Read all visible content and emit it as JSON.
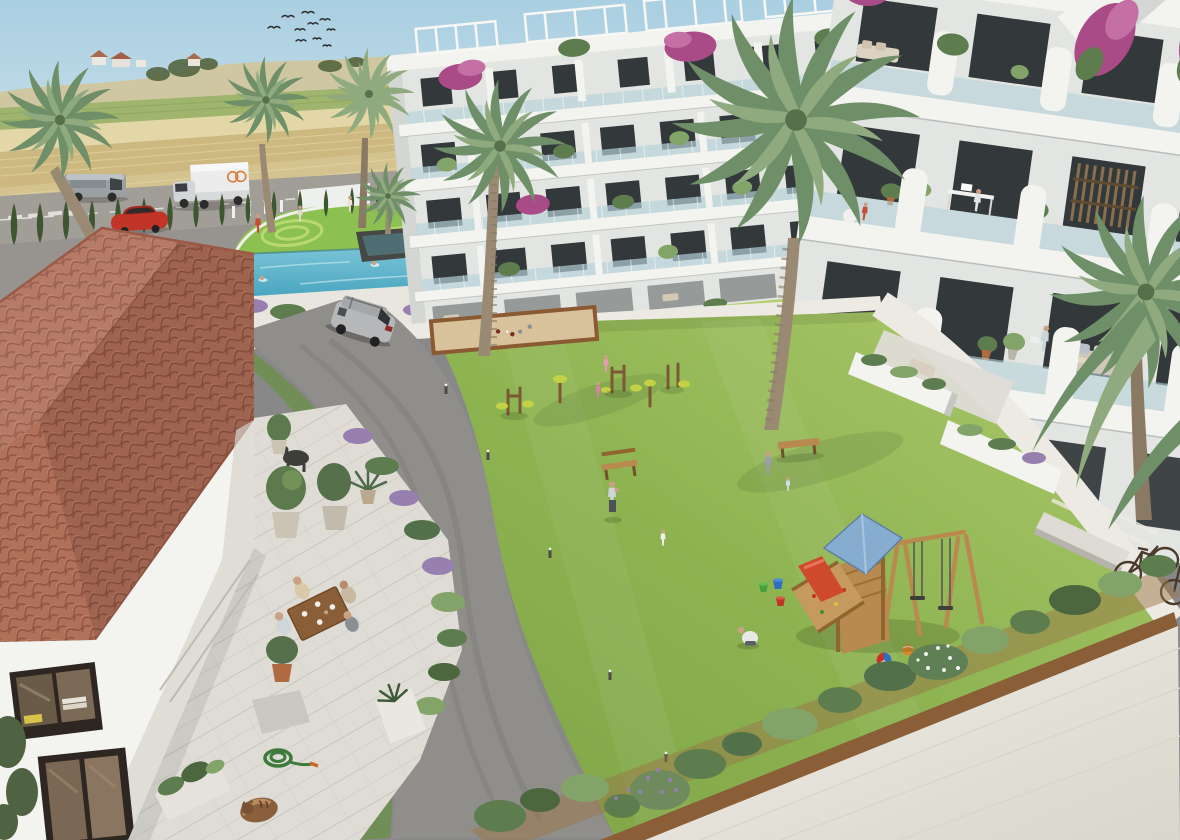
{
  "meta": {
    "kind": "architectural-aerial-render",
    "width": 1180,
    "height": 840
  },
  "scene": {
    "description": "Aerial 3D render of a Mediterranean residential development: modern white apartment blocks with glass balconies wrap a landscaped courtyard containing a lawn, swimming pool, putting green, petanque sand court, outdoor exercise equipment and a wooden playground; a terracotta-roofed house with a dining terrace sits in the foreground and farmland with a perimeter road lies beyond."
  },
  "labels": {
    "sky": "Sky",
    "birds": "Flock of birds",
    "farmland": "Farmland and distant houses",
    "road": "Perimeter road",
    "van": "Grey van",
    "truck": "White delivery truck",
    "redCar": "Red parked car",
    "boundary": "White boundary wall",
    "cypress": "Cypress hedge row",
    "parking": "Entrance parking strip",
    "gatePerson": "Person at entrance",
    "golf": "Putting green",
    "pool": "Swimming pool",
    "fountain": "Dark planter with palm",
    "poolShrubs": "Shrubs beside pool",
    "courtyard": "Courtyard gardens",
    "raisedBed": "Raised stone planter with water channel",
    "lounge": "Sunken lounge",
    "centerBuilding": "Centre apartment block",
    "pergolas": "Roof pergolas",
    "rightBuilding": "Right apartment block",
    "deskResident": "Resident working at desk",
    "wateringResident": "Resident watering balcony plants",
    "balconySofa": "Balcony sofa",
    "bougainvillea": "Bougainvillea",
    "topPath": "Upper walkway",
    "innerRoad": "Curved asphalt driveway",
    "suv": "Silver SUV",
    "lawn": "Central lawn",
    "bocce": "Petanque sand court",
    "exercise": "Outdoor exercise equipment",
    "benches": "Wooden benches",
    "bollards": "Path light bollards",
    "people": "Residents on the lawn",
    "toys": "Buckets and balls",
    "playground": "Wooden play tower with swings and slide",
    "rightGarden": "Terrace planters",
    "rightPath": "Side walkway",
    "bench": "Concrete bench",
    "bicycles": "Bicycles",
    "palms": "Palm trees",
    "house": "Terracotta-roofed house",
    "houseRoof": "Clay tile roof",
    "houseWindow": "House window with books",
    "houseDoor": "House door",
    "terrace": "House terrace",
    "diners": "Family dining at table",
    "statue": "Garden statue",
    "pots": "Potted olive trees",
    "hose": "Coiled garden hose",
    "cat": "Sleeping cat",
    "hedge": "Shrub and lavender border",
    "pavement": "Stone pavement"
  },
  "inventory": {
    "palm_trees": 7,
    "vehicles": 4,
    "bicycles": 2,
    "swimmers": 3,
    "people_visible": 20,
    "apartment_floors_centre": 5,
    "apartment_floors_right": 4
  },
  "palette": {
    "sky1": "#a9cfe2",
    "sky2": "#e4efe9",
    "hill": "#cfc7a2",
    "hillTree": "#55663f",
    "fieldPale": "#d4c38f",
    "fieldGold": "#cdb97f",
    "fieldGreen": "#9fb46c",
    "fieldLight": "#e3d7a8",
    "roadGray": "#a19d97",
    "roadLine": "#e9e7e2",
    "asphalt": "#908e8a",
    "asphaltDk": "#7d7b77",
    "cypress": "#3d5530",
    "wall": "#eef0ee",
    "lawn": "#97bb58",
    "lawnDk": "#7fa84a",
    "lawnLt": "#aac96a",
    "golf": "#8cc152",
    "golfLt": "#b9d96e",
    "pool": "#4aa6c0",
    "poolLt": "#7cc5d8",
    "deck": "#e8e6df",
    "white": "#f3f3ef",
    "shade": "#c9cdcd",
    "facade": "#e3e5e2",
    "glass": "#b7d2da",
    "win": "#33383b",
    "leaf": "#5d7d4e",
    "leafLt": "#83a468",
    "palm": "#6e8f68",
    "palmLt": "#8faa7e",
    "trunk": "#9a8a74",
    "boug": "#a84b86",
    "bougLt": "#c470a5",
    "tile": "#b0705a",
    "tileDk": "#8f5241",
    "tileLt": "#c68a72",
    "marble": "#dedcd5",
    "sand": "#d8c29c",
    "sandEdge": "#8a5a33",
    "wood": "#b98a50",
    "woodDk": "#8f6530",
    "playBlue": "#86add0",
    "playRed": "#cf4a2c",
    "eqYellow": "#c2d243",
    "eqBrown": "#7b5a33",
    "skin": "#c9a184",
    "silver": "#b5b7b9",
    "red": "#c23427",
    "truckW": "#ececec",
    "van": "#9aa0a4",
    "lav": "#977fb0",
    "stone": "#b7b5ac",
    "dark": "#3a3a38",
    "water": "#4e6e74",
    "pave": "#eceae2"
  }
}
